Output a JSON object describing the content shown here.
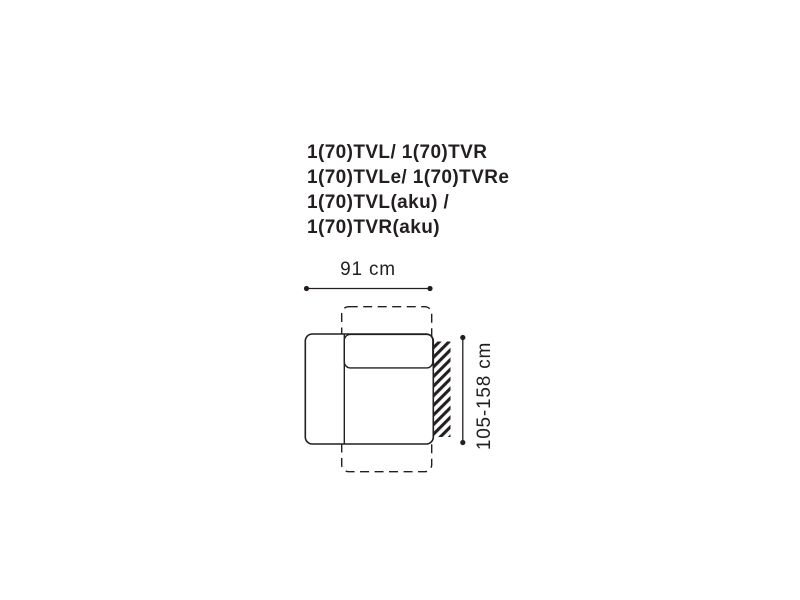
{
  "colors": {
    "ink": "#231f20",
    "background": "#ffffff"
  },
  "title": {
    "lines": [
      "1(70)TVL/ 1(70)TVR",
      "1(70)TVLe/ 1(70)TVRe",
      "1(70)TVL(aku) /",
      "1(70)TVR(aku)"
    ]
  },
  "dimensions": {
    "width": {
      "label": "91 cm"
    },
    "depth": {
      "label": "105-158 cm"
    }
  },
  "diagram": {
    "description": "top view of sofa module with left armrest, backrest cushion, dashed pull-out extension outline and hatched wall on the right"
  }
}
